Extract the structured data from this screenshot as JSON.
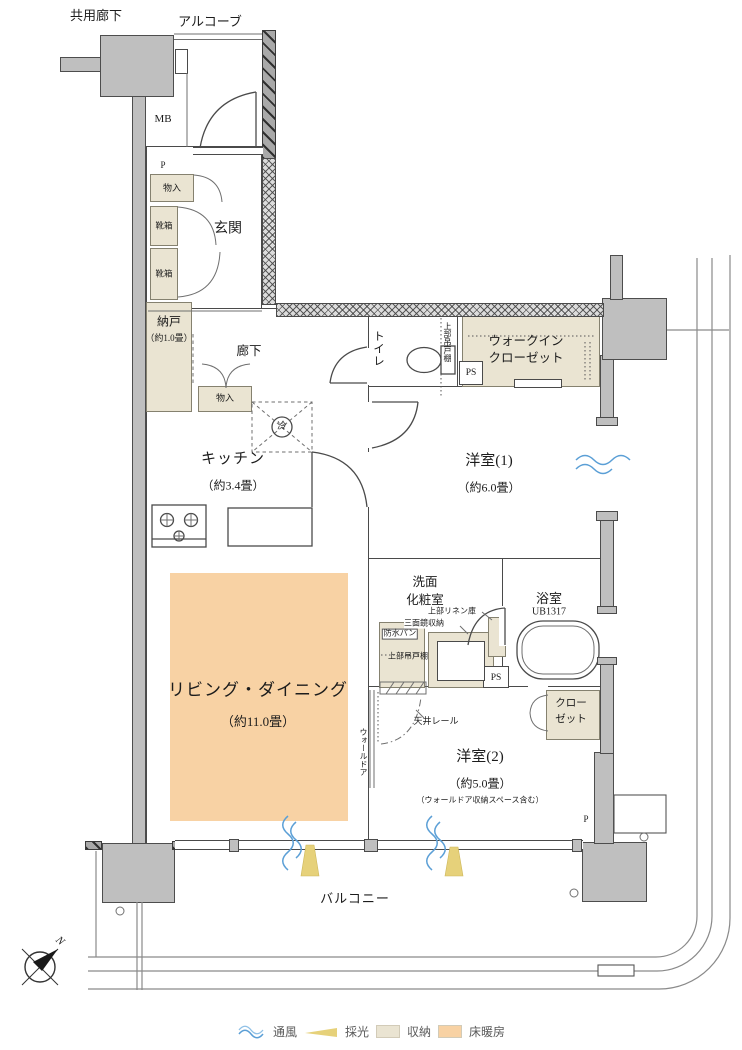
{
  "exterior": {
    "shared_corridor": "共用廊下",
    "alcove": "アルコーブ",
    "meter_box": "MB",
    "balcony": "バルコニー",
    "compass_north": "N"
  },
  "entrance": {
    "name": "玄関",
    "pipe": "P",
    "storage": "物入",
    "shoe_box_upper": "靴箱",
    "shoe_box_lower": "靴箱"
  },
  "storeroom": {
    "name": "納戸",
    "size": "（約1.0畳）"
  },
  "hallway": {
    "name": "廊下",
    "storage": "物入",
    "fridge_mark": "冷"
  },
  "kitchen": {
    "name": "キッチン",
    "size": "（約3.4畳）"
  },
  "living": {
    "name": "リビング・ダイニング",
    "size": "（約11.0畳）",
    "wall_door": "ウォールドア"
  },
  "toilet": {
    "name": "トイレ",
    "upper_cabinet": "上部吊戸棚"
  },
  "pipe_space_upper": "PS",
  "pipe_space_lower": "PS",
  "wic": {
    "line1": "ウォークイン",
    "line2": "クローゼット"
  },
  "bedroom1": {
    "name": "洋室(1)",
    "size": "（約6.0畳）"
  },
  "washroom": {
    "line1": "洗面",
    "line2": "化粧室",
    "upper_linen": "上部リネン庫",
    "mirror_cabinet": "三面鏡収納",
    "waterproof_pan": "防水パン",
    "upper_cabinet": "上部吊戸棚"
  },
  "bathroom": {
    "name": "浴室",
    "unit_size": "UB1317"
  },
  "closet": {
    "line1": "クロー",
    "line2": "ゼット"
  },
  "bedroom2": {
    "name": "洋室(2)",
    "size": "（約5.0畳）",
    "note": "（ウォールドア収納スペース含む）",
    "ceiling_rail": "天井レール",
    "pipe": "P"
  },
  "legend": {
    "ventilation": "通風",
    "daylight": "採光",
    "storage": "収納",
    "floor_heating": "床暖房"
  },
  "colors": {
    "wall": "#bfbfbf",
    "storage_fill": "#eae4d2",
    "floor_heating_fill": "#f8d2a4",
    "ventilation_blue": "#5b9fd6",
    "daylight_yellow": "#e6d17a",
    "line": "#4a4a4a"
  }
}
